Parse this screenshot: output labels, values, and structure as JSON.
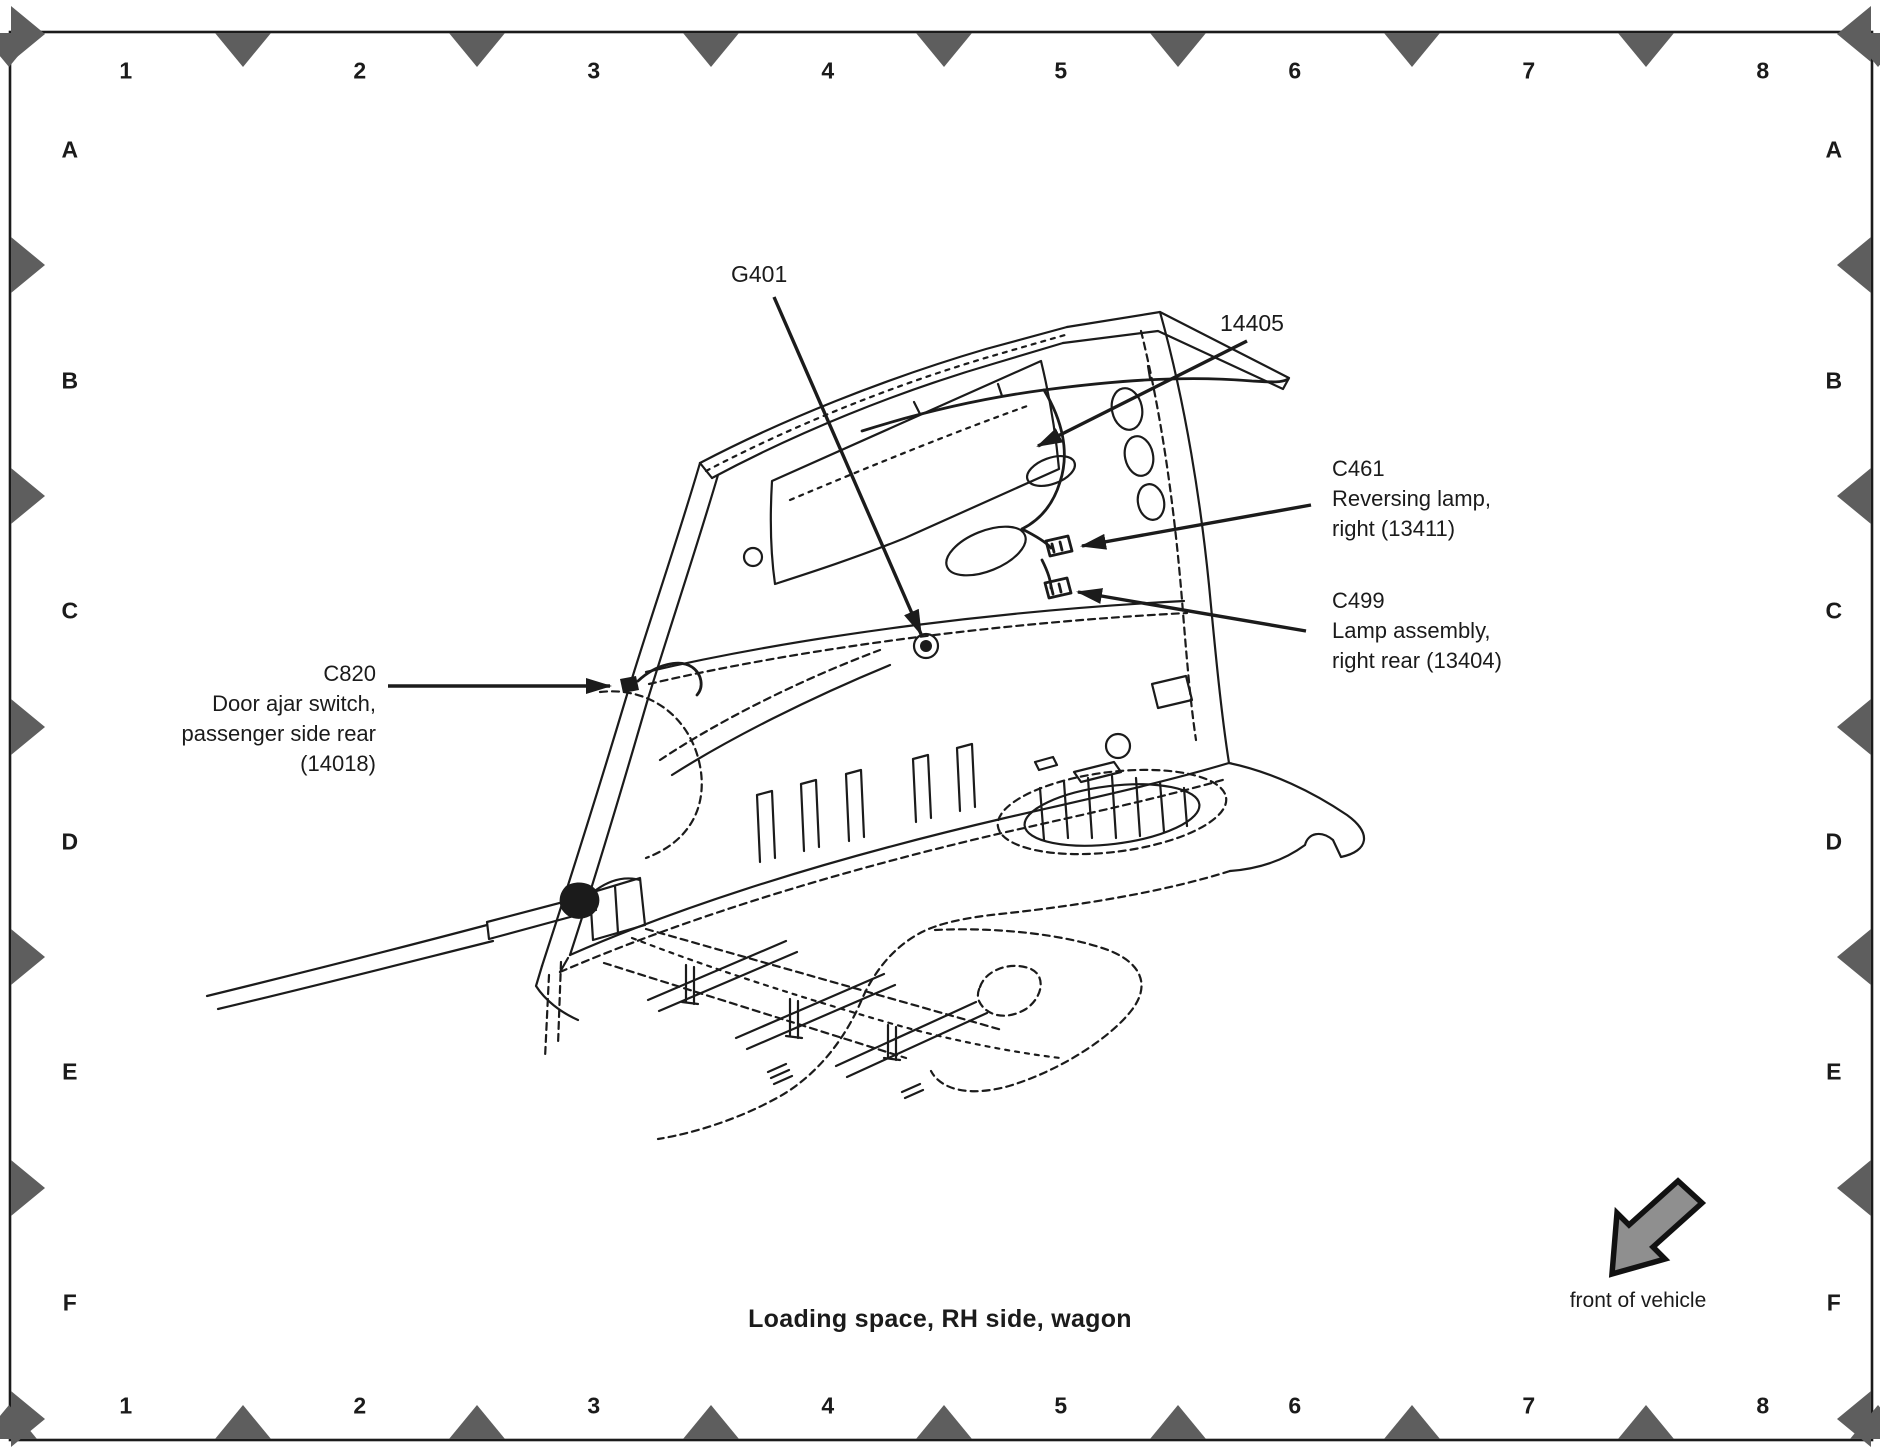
{
  "document": {
    "caption": "Loading space, RH side, wagon",
    "orientation_label": "front of vehicle"
  },
  "grid": {
    "columns": [
      "1",
      "2",
      "3",
      "4",
      "5",
      "6",
      "7",
      "8"
    ],
    "rows": [
      "A",
      "B",
      "C",
      "D",
      "E",
      "F"
    ]
  },
  "callouts": {
    "g401": {
      "code": "G401"
    },
    "harness14405": {
      "code": "14405"
    },
    "c461": {
      "code": "C461",
      "line1": "Reversing lamp,",
      "line2": "right (13411)"
    },
    "c499": {
      "code": "C499",
      "line1": "Lamp assembly,",
      "line2": "right rear (13404)"
    },
    "c820": {
      "code": "C820",
      "line1": "Door ajar switch,",
      "line2": "passenger side rear",
      "line3": "(14018)"
    }
  },
  "colors": {
    "ink": "#1b1b1b",
    "marker": "#5e5e5e",
    "paper": "#ffffff"
  }
}
